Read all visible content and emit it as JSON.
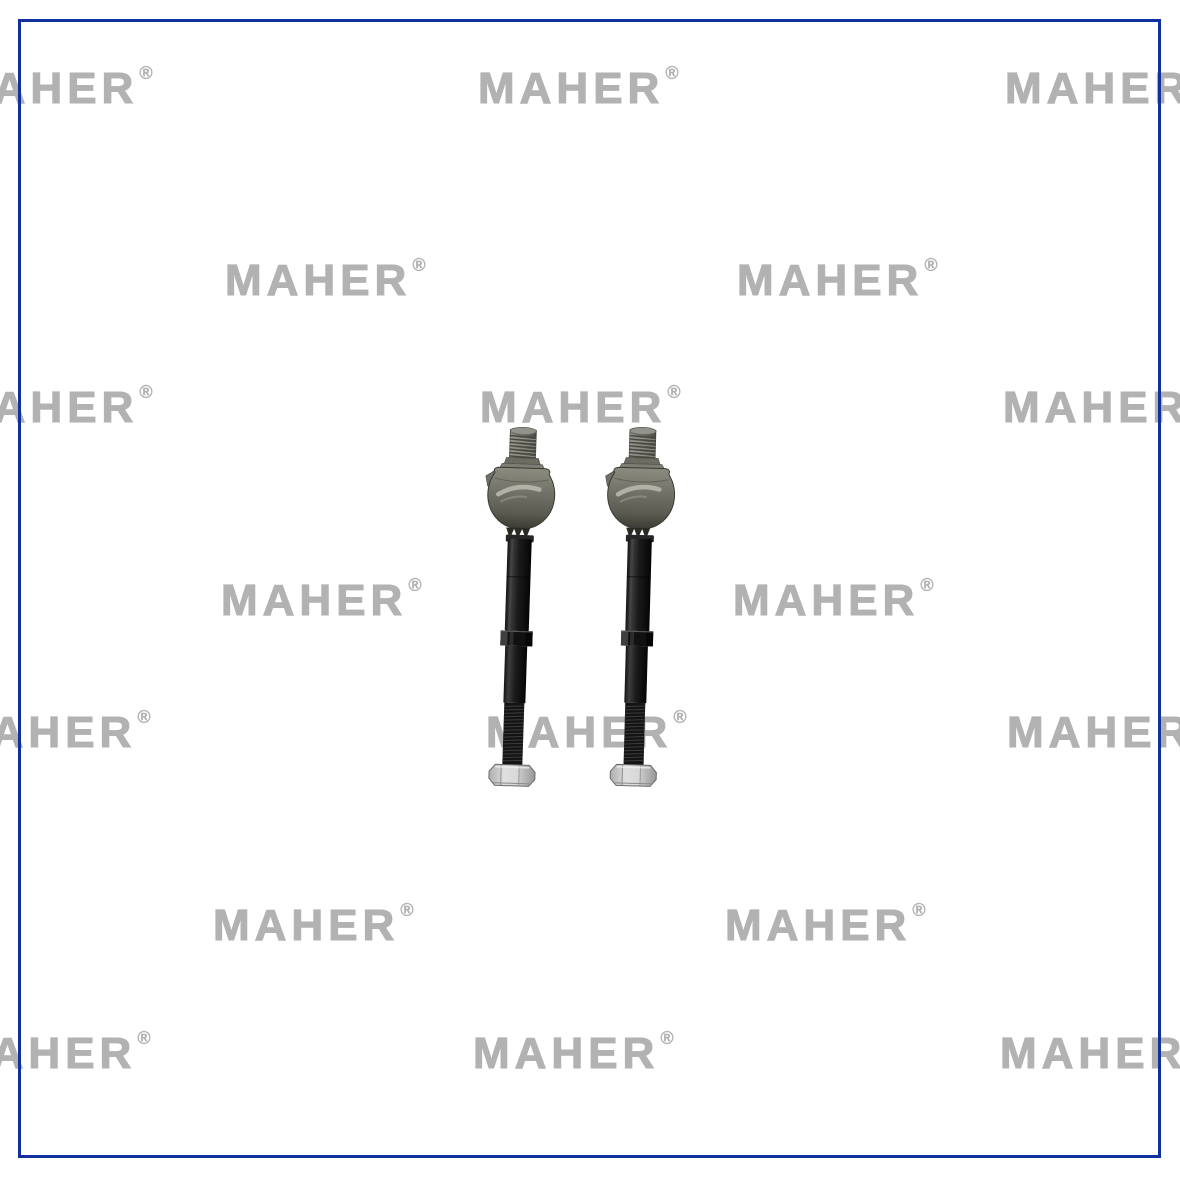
{
  "page": {
    "background_color": "#ffffff"
  },
  "border": {
    "color": "#10309f",
    "inset_px": 19,
    "thickness_px": 3
  },
  "watermark": {
    "text": "MAHER",
    "registered_mark": "®",
    "color": "#b2b2b2",
    "rows": [
      {
        "y": 73,
        "xs": [
          -48,
          478,
          1005
        ]
      },
      {
        "y": 265,
        "xs": [
          225,
          737
        ]
      },
      {
        "y": 392,
        "xs": [
          -48,
          480,
          1003
        ]
      },
      {
        "y": 585,
        "xs": [
          221,
          733
        ]
      },
      {
        "y": 717,
        "xs": [
          -50,
          486,
          1007
        ]
      },
      {
        "y": 910,
        "xs": [
          213,
          725
        ]
      },
      {
        "y": 1038,
        "xs": [
          -50,
          473,
          1000
        ]
      }
    ]
  },
  "product_photo": {
    "item_icon": "inner-tie-rod-axial-joint",
    "count": 2,
    "positions": [
      {
        "x": 483.5,
        "y": 427,
        "tilt_deg": 1.9
      },
      {
        "x": 603.0,
        "y": 427,
        "tilt_deg": 1.6
      }
    ],
    "part_colors": {
      "housing": "#72726a",
      "housing_highlight": "#b8b8ac",
      "rod": "#191919",
      "nut": "#c9c9c9"
    }
  }
}
